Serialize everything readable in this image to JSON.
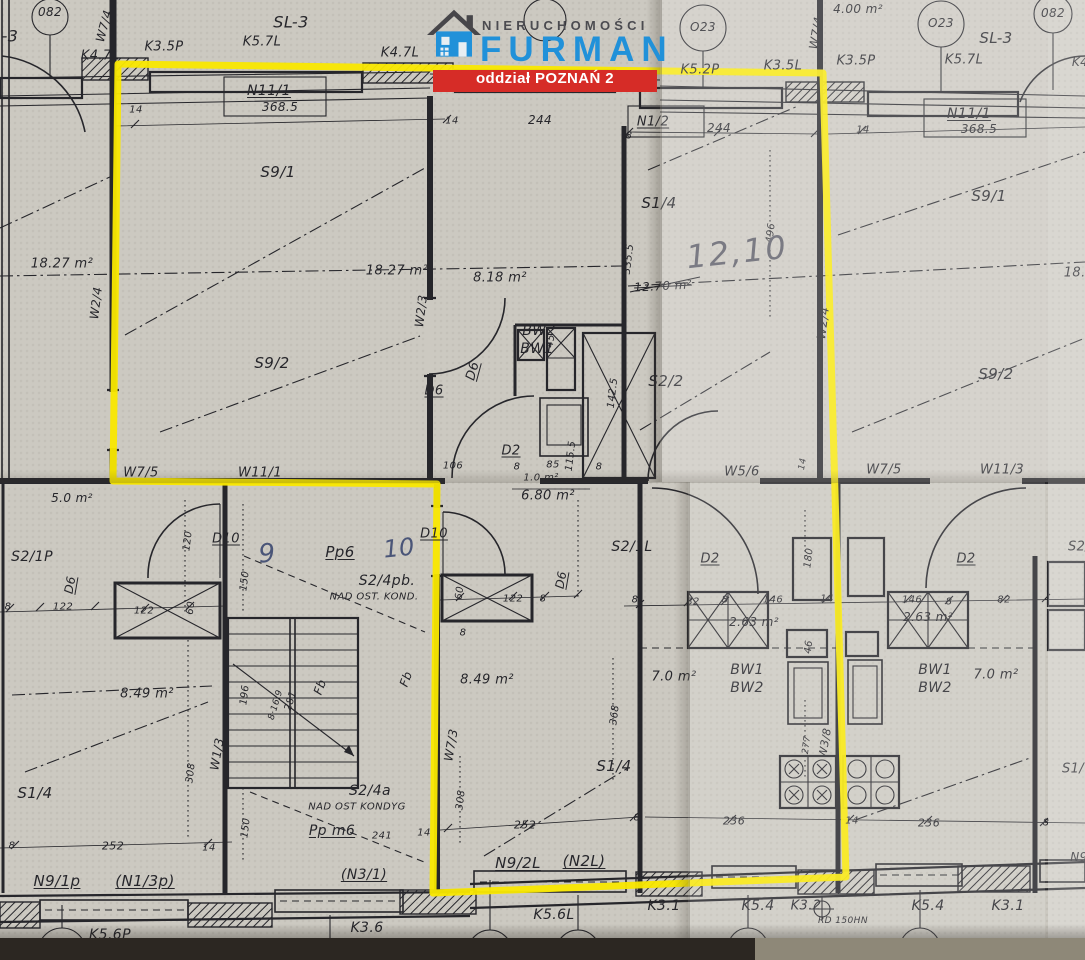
{
  "logo": {
    "brand_top": "NIERUCHOMOŚCI",
    "brand_name": "FURMAN",
    "banner": "oddział POZNAŃ 2"
  },
  "colors": {
    "paper": "#ccc9c1",
    "ink": "#26262b",
    "highlight": "#f9e800",
    "brandblue": "#2191d9",
    "bannerred": "#d62c27",
    "desk": "#2c2722",
    "desklight": "#8e8878",
    "pencil": "#595964",
    "pen": "#4a5578"
  },
  "plan": {
    "description": "Scanned architectural floor plan with yellow highlighted apartment outline",
    "labels": [
      {
        "t": "082",
        "x": 50,
        "y": 12,
        "s": 12
      },
      {
        "t": "-3",
        "x": 10,
        "y": 36,
        "s": 16
      },
      {
        "t": "W7/4",
        "x": 104,
        "y": 26,
        "r": -75,
        "s": 12
      },
      {
        "t": "K4.7L",
        "x": 100,
        "y": 56
      },
      {
        "t": "K3.5P",
        "x": 164,
        "y": 47
      },
      {
        "t": "SL-3",
        "x": 291,
        "y": 22,
        "s": 16
      },
      {
        "t": "K5.7L",
        "x": 262,
        "y": 42
      },
      {
        "t": "K4.7L",
        "x": 400,
        "y": 53
      },
      {
        "t": "N11/1",
        "x": 269,
        "y": 91,
        "s": 14,
        "u": 1
      },
      {
        "t": "368.5",
        "x": 280,
        "y": 107,
        "s": 12
      },
      {
        "t": "14",
        "x": 136,
        "y": 110,
        "s": 10
      },
      {
        "t": "O23",
        "x": 703,
        "y": 27,
        "s": 12
      },
      {
        "t": "K5.2P",
        "x": 700,
        "y": 70
      },
      {
        "t": "W7/4",
        "x": 816,
        "y": 33,
        "r": -80,
        "s": 12
      },
      {
        "t": "4.00 m²",
        "x": 858,
        "y": 9,
        "s": 12
      },
      {
        "t": "K3.5L",
        "x": 783,
        "y": 66
      },
      {
        "t": "K3.5P",
        "x": 856,
        "y": 61
      },
      {
        "t": "O23",
        "x": 941,
        "y": 23,
        "s": 12
      },
      {
        "t": "SL-3",
        "x": 996,
        "y": 38,
        "s": 15
      },
      {
        "t": "K5.7L",
        "x": 964,
        "y": 60
      },
      {
        "t": "082",
        "x": 1053,
        "y": 13,
        "s": 12
      },
      {
        "t": "K4",
        "x": 1080,
        "y": 62,
        "s": 12
      },
      {
        "t": "N11/1",
        "x": 969,
        "y": 114,
        "s": 14,
        "u": 1
      },
      {
        "t": "368.5",
        "x": 979,
        "y": 129,
        "s": 12
      },
      {
        "t": "N1/2",
        "x": 653,
        "y": 122,
        "u": 1
      },
      {
        "t": "244",
        "x": 540,
        "y": 120,
        "s": 12
      },
      {
        "t": "14",
        "x": 452,
        "y": 121,
        "s": 10
      },
      {
        "t": "8",
        "x": 629,
        "y": 136,
        "s": 10
      },
      {
        "t": "244",
        "x": 719,
        "y": 128,
        "s": 12
      },
      {
        "t": "14",
        "x": 863,
        "y": 130,
        "s": 10
      },
      {
        "t": "S9/1",
        "x": 278,
        "y": 172,
        "s": 15
      },
      {
        "t": "S1/4",
        "x": 659,
        "y": 203,
        "s": 15
      },
      {
        "t": "S9/1",
        "x": 989,
        "y": 196,
        "s": 15
      },
      {
        "t": "496",
        "x": 771,
        "y": 233,
        "r": -83,
        "s": 10
      },
      {
        "t": "335.5",
        "x": 629,
        "y": 259,
        "r": -83,
        "s": 10
      },
      {
        "t": "18.27 m²",
        "x": 62,
        "y": 264
      },
      {
        "t": "18.27 m²",
        "x": 397,
        "y": 271
      },
      {
        "t": "8.18 m²",
        "x": 500,
        "y": 278
      },
      {
        "t": "12,10",
        "x": 737,
        "y": 252,
        "s": 32,
        "c": "hand",
        "r": -6
      },
      {
        "t": "12.70 m²",
        "x": 663,
        "y": 286,
        "s": 12,
        "c": "strike",
        "r": -3
      },
      {
        "t": "18.2",
        "x": 1079,
        "y": 273
      },
      {
        "t": "W2/4",
        "x": 96,
        "y": 303,
        "r": -83,
        "s": 12
      },
      {
        "t": "W2/3",
        "x": 421,
        "y": 311,
        "r": -83,
        "s": 12
      },
      {
        "t": "W2/4",
        "x": 823,
        "y": 323,
        "r": -83,
        "s": 12
      },
      {
        "t": "S9/2",
        "x": 272,
        "y": 363,
        "s": 15
      },
      {
        "t": "BW2",
        "x": 539,
        "y": 331,
        "s": 14
      },
      {
        "t": "BW1",
        "x": 537,
        "y": 349,
        "s": 14
      },
      {
        "t": "D6",
        "x": 473,
        "y": 371,
        "r": -75,
        "u": 1
      },
      {
        "t": "D6",
        "x": 434,
        "y": 391,
        "u": 1
      },
      {
        "t": "45",
        "x": 551,
        "y": 341,
        "r": -83,
        "s": 10
      },
      {
        "t": "142.5",
        "x": 613,
        "y": 393,
        "r": -83,
        "s": 10
      },
      {
        "t": "S2/2",
        "x": 666,
        "y": 381,
        "s": 15
      },
      {
        "t": "S9/2",
        "x": 996,
        "y": 374,
        "s": 15
      },
      {
        "t": "D2",
        "x": 511,
        "y": 451,
        "u": 1
      },
      {
        "t": "106",
        "x": 453,
        "y": 466,
        "s": 10
      },
      {
        "t": "8",
        "x": 517,
        "y": 467,
        "s": 10
      },
      {
        "t": "85",
        "x": 553,
        "y": 465,
        "s": 10
      },
      {
        "t": "115.5",
        "x": 571,
        "y": 456,
        "r": -83,
        "s": 10
      },
      {
        "t": "8",
        "x": 599,
        "y": 467,
        "s": 10
      },
      {
        "t": "1.0 m²",
        "x": 541,
        "y": 478,
        "s": 10
      },
      {
        "t": "6.80 m²",
        "x": 548,
        "y": 496
      },
      {
        "t": "W7/5",
        "x": 141,
        "y": 473
      },
      {
        "t": "W11/1",
        "x": 260,
        "y": 473
      },
      {
        "t": "5.0 m²",
        "x": 72,
        "y": 498,
        "s": 12
      },
      {
        "t": "W5/6",
        "x": 742,
        "y": 472
      },
      {
        "t": "14",
        "x": 803,
        "y": 464,
        "r": -80,
        "s": 9
      },
      {
        "t": "W7/5",
        "x": 884,
        "y": 470
      },
      {
        "t": "W11/3",
        "x": 1002,
        "y": 470
      },
      {
        "t": "S2/1P",
        "x": 32,
        "y": 557,
        "s": 14
      },
      {
        "t": "120",
        "x": 188,
        "y": 541,
        "r": -83,
        "s": 10
      },
      {
        "t": "D10",
        "x": 226,
        "y": 539,
        "u": 1
      },
      {
        "t": "150",
        "x": 245,
        "y": 581,
        "r": -83,
        "s": 10
      },
      {
        "t": "9",
        "x": 267,
        "y": 554,
        "s": 26,
        "c": "handblue",
        "r": -4
      },
      {
        "t": "Pp6",
        "x": 340,
        "y": 552,
        "s": 15,
        "u": 1
      },
      {
        "t": "10",
        "x": 399,
        "y": 548,
        "s": 24,
        "c": "handblue",
        "r": -6
      },
      {
        "t": "D10",
        "x": 434,
        "y": 534,
        "u": 1
      },
      {
        "t": "S2/4pb.",
        "x": 387,
        "y": 581,
        "s": 14
      },
      {
        "t": "NAD OST. KOND.",
        "x": 374,
        "y": 597,
        "s": 10
      },
      {
        "t": "S2/1L",
        "x": 632,
        "y": 547,
        "s": 14
      },
      {
        "t": "D2",
        "x": 710,
        "y": 559,
        "u": 1
      },
      {
        "t": "180",
        "x": 809,
        "y": 558,
        "r": -83,
        "s": 10
      },
      {
        "t": "D2",
        "x": 966,
        "y": 559,
        "u": 1
      },
      {
        "t": "S2/",
        "x": 1079,
        "y": 547
      },
      {
        "t": "D6",
        "x": 70,
        "y": 585,
        "r": -80,
        "s": 12,
        "u": 1
      },
      {
        "t": "8",
        "x": 8,
        "y": 607,
        "s": 10
      },
      {
        "t": "122",
        "x": 63,
        "y": 607,
        "s": 10
      },
      {
        "t": "122",
        "x": 144,
        "y": 611,
        "s": 10
      },
      {
        "t": "60",
        "x": 191,
        "y": 608,
        "r": -83,
        "s": 10
      },
      {
        "t": "60",
        "x": 460,
        "y": 593,
        "r": -83,
        "s": 10
      },
      {
        "t": "122",
        "x": 513,
        "y": 599,
        "s": 10
      },
      {
        "t": "8",
        "x": 543,
        "y": 599,
        "s": 10
      },
      {
        "t": "D6",
        "x": 561,
        "y": 580,
        "r": -80,
        "s": 12,
        "u": 1
      },
      {
        "t": "8",
        "x": 635,
        "y": 600,
        "s": 10
      },
      {
        "t": "82",
        "x": 693,
        "y": 602,
        "s": 10
      },
      {
        "t": "8",
        "x": 725,
        "y": 600,
        "s": 10
      },
      {
        "t": "146",
        "x": 773,
        "y": 600,
        "s": 10
      },
      {
        "t": "14",
        "x": 827,
        "y": 599,
        "s": 10
      },
      {
        "t": "2.63 m²",
        "x": 754,
        "y": 622,
        "s": 12
      },
      {
        "t": "46",
        "x": 809,
        "y": 647,
        "r": -83,
        "s": 10
      },
      {
        "t": "146",
        "x": 912,
        "y": 600,
        "s": 10
      },
      {
        "t": "8",
        "x": 949,
        "y": 602,
        "s": 10
      },
      {
        "t": "82",
        "x": 1004,
        "y": 600,
        "s": 10
      },
      {
        "t": "2.63 m²",
        "x": 928,
        "y": 617,
        "s": 12
      },
      {
        "t": "8",
        "x": 463,
        "y": 633,
        "s": 10
      },
      {
        "t": "8.49 m²",
        "x": 147,
        "y": 694
      },
      {
        "t": "8.49 m²",
        "x": 487,
        "y": 680
      },
      {
        "t": "7.0 m²",
        "x": 674,
        "y": 677
      },
      {
        "t": "BW1",
        "x": 747,
        "y": 670,
        "s": 14
      },
      {
        "t": "BW2",
        "x": 747,
        "y": 688,
        "s": 14
      },
      {
        "t": "BW1",
        "x": 935,
        "y": 670,
        "s": 14
      },
      {
        "t": "BW2",
        "x": 935,
        "y": 688,
        "s": 14
      },
      {
        "t": "7.0 m²",
        "x": 996,
        "y": 675
      },
      {
        "t": "196",
        "x": 245,
        "y": 695,
        "r": -83,
        "s": 10
      },
      {
        "t": "8·16.9",
        "x": 276,
        "y": 705,
        "r": -73,
        "s": 9
      },
      {
        "t": "281",
        "x": 291,
        "y": 701,
        "r": -73,
        "s": 10
      },
      {
        "t": "Fb",
        "x": 320,
        "y": 687,
        "r": -70,
        "s": 12
      },
      {
        "t": "Fb",
        "x": 406,
        "y": 679,
        "r": -70,
        "s": 12
      },
      {
        "t": "W1/3",
        "x": 217,
        "y": 754,
        "r": -80,
        "s": 12
      },
      {
        "t": "308",
        "x": 191,
        "y": 773,
        "r": -83,
        "s": 10
      },
      {
        "t": "S1/4",
        "x": 35,
        "y": 793,
        "s": 15
      },
      {
        "t": "W7/3",
        "x": 451,
        "y": 745,
        "r": -80,
        "s": 12
      },
      {
        "t": "368",
        "x": 615,
        "y": 715,
        "r": -83,
        "s": 10
      },
      {
        "t": "S1/4",
        "x": 614,
        "y": 766,
        "s": 15
      },
      {
        "t": "308",
        "x": 461,
        "y": 800,
        "r": -83,
        "s": 10
      },
      {
        "t": "277",
        "x": 807,
        "y": 745,
        "r": -83,
        "s": 9
      },
      {
        "t": "W3/8",
        "x": 825,
        "y": 743,
        "r": -80,
        "s": 11
      },
      {
        "t": "S1/",
        "x": 1073,
        "y": 769
      },
      {
        "t": "150",
        "x": 246,
        "y": 828,
        "r": -83,
        "s": 10
      },
      {
        "t": "S2/4a",
        "x": 370,
        "y": 791,
        "s": 14
      },
      {
        "t": "NAD OST KONDYG",
        "x": 357,
        "y": 807,
        "s": 10
      },
      {
        "t": "Pp m6",
        "x": 332,
        "y": 831,
        "s": 14,
        "u": 1
      },
      {
        "t": "241",
        "x": 382,
        "y": 836,
        "s": 10
      },
      {
        "t": "14",
        "x": 424,
        "y": 833,
        "s": 10
      },
      {
        "t": "8",
        "x": 12,
        "y": 846,
        "s": 10
      },
      {
        "t": "252",
        "x": 113,
        "y": 846,
        "s": 11
      },
      {
        "t": "14",
        "x": 209,
        "y": 848,
        "s": 10
      },
      {
        "t": "N9/1p",
        "x": 57,
        "y": 881,
        "s": 15,
        "u": 1
      },
      {
        "t": "(N1/3p)",
        "x": 145,
        "y": 881,
        "s": 15,
        "u": 1
      },
      {
        "t": "(N3/1)",
        "x": 364,
        "y": 875,
        "s": 14,
        "u": 1
      },
      {
        "t": "252",
        "x": 525,
        "y": 825,
        "s": 11
      },
      {
        "t": "8",
        "x": 637,
        "y": 818,
        "s": 10
      },
      {
        "t": "236",
        "x": 734,
        "y": 821,
        "s": 11
      },
      {
        "t": "14",
        "x": 852,
        "y": 821,
        "s": 10
      },
      {
        "t": "236",
        "x": 929,
        "y": 823,
        "s": 11
      },
      {
        "t": "8",
        "x": 1046,
        "y": 823,
        "s": 10
      },
      {
        "t": "N9/2L",
        "x": 518,
        "y": 863,
        "s": 15,
        "u": 1
      },
      {
        "t": "(N2L)",
        "x": 584,
        "y": 861,
        "s": 15,
        "u": 1
      },
      {
        "t": "N9",
        "x": 1079,
        "y": 857,
        "s": 12
      },
      {
        "t": "K5.6P",
        "x": 110,
        "y": 935,
        "s": 14
      },
      {
        "t": "K3.6",
        "x": 367,
        "y": 928,
        "s": 14
      },
      {
        "t": "K5.6L",
        "x": 554,
        "y": 915,
        "s": 14
      },
      {
        "t": "K3.1",
        "x": 664,
        "y": 906,
        "s": 14
      },
      {
        "t": "K5.4",
        "x": 758,
        "y": 906,
        "s": 14
      },
      {
        "t": "K3.2",
        "x": 806,
        "y": 906
      },
      {
        "t": "RD 150HN",
        "x": 843,
        "y": 921,
        "s": 9
      },
      {
        "t": "K5.4",
        "x": 928,
        "y": 906,
        "s": 14
      },
      {
        "t": "K3.1",
        "x": 1008,
        "y": 906,
        "s": 14
      }
    ]
  }
}
